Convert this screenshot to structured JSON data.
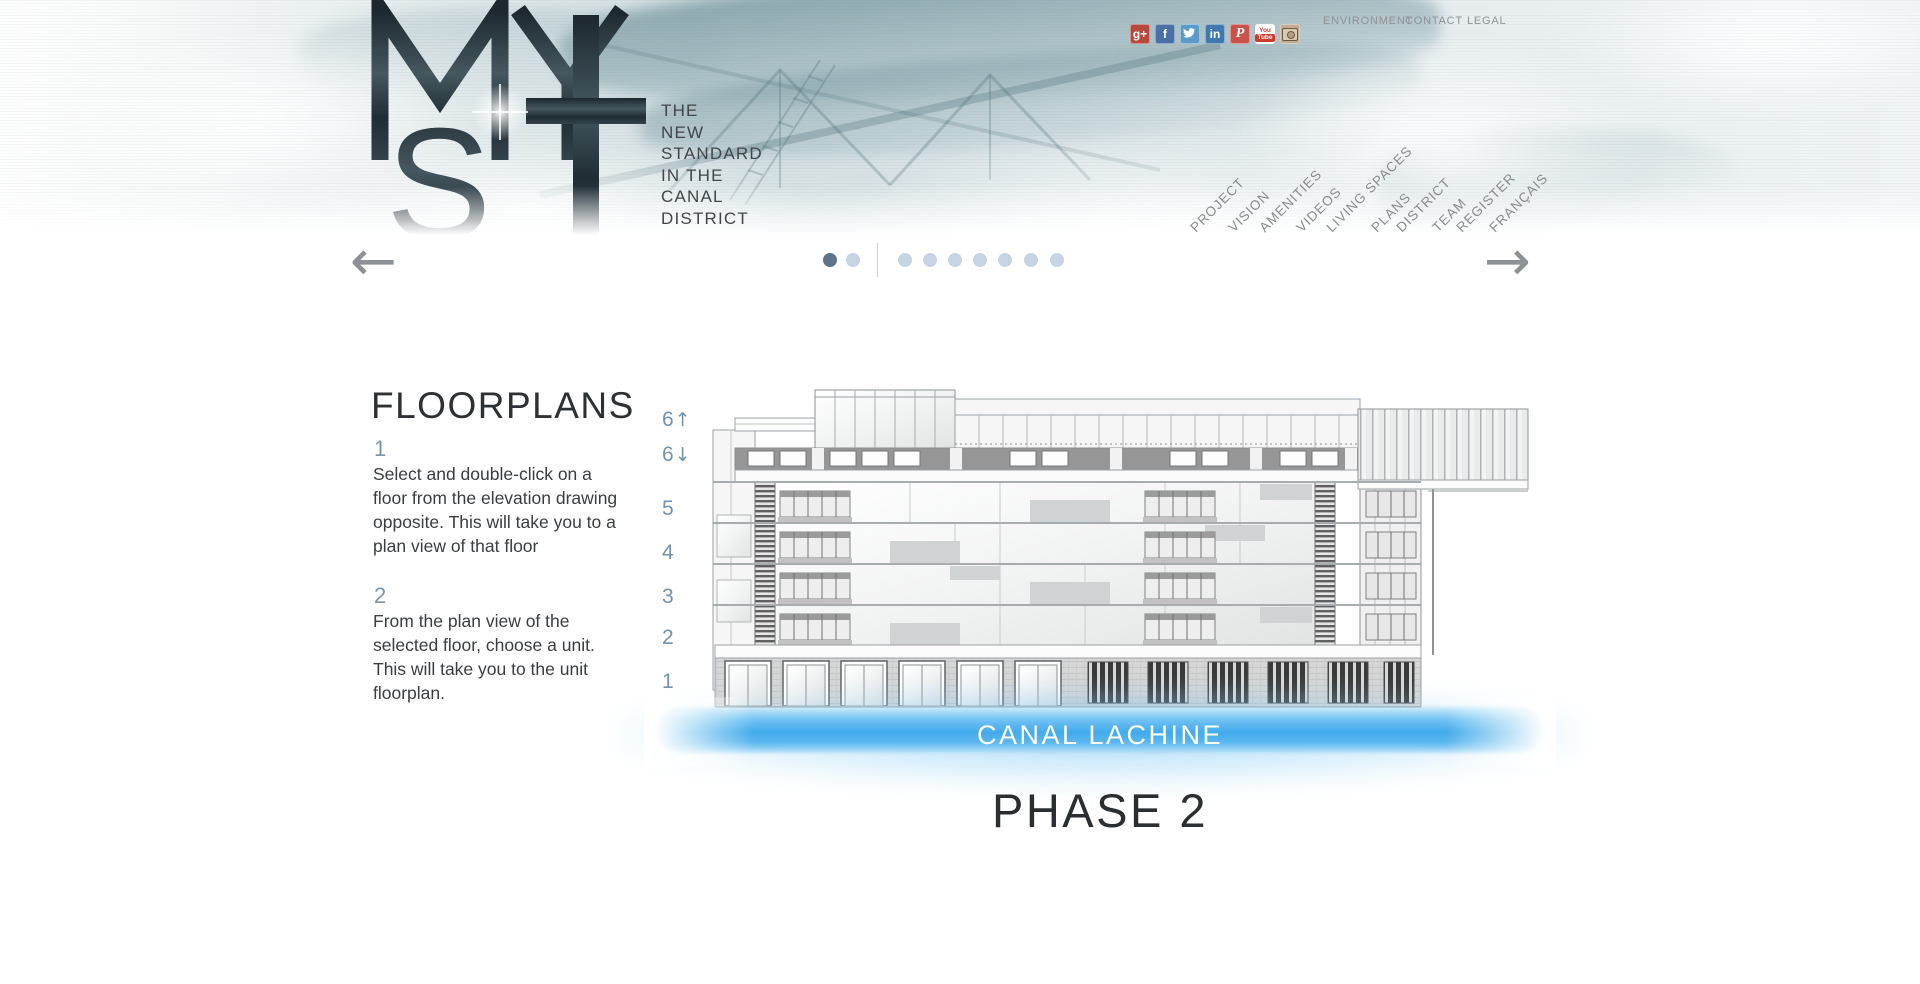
{
  "header": {
    "logo_letters": [
      "M",
      "Y",
      "S",
      "T"
    ],
    "tagline_lines": [
      "THE",
      "NEW",
      "STANDARD",
      "IN THE",
      "CANAL",
      "DISTRICT"
    ],
    "social": [
      {
        "name": "google-plus",
        "glyph": "g+",
        "color": "#b6493b"
      },
      {
        "name": "facebook",
        "glyph": "f",
        "color": "#4a70a8"
      },
      {
        "name": "twitter",
        "color": "#5b9bca"
      },
      {
        "name": "linkedin",
        "glyph": "in",
        "color": "#3e7ab0"
      },
      {
        "name": "pinterest",
        "glyph": "P",
        "color": "#c9524b"
      },
      {
        "name": "youtube",
        "glyph_top": "You",
        "glyph_bottom": "Tube",
        "color": "#ffffff",
        "accent": "#cc3a2c"
      },
      {
        "name": "instagram",
        "color": "#c3ac92"
      }
    ],
    "top_links": [
      {
        "label": "ENVIRONMENT"
      },
      {
        "label": "CONTACT"
      },
      {
        "label": "LEGAL"
      }
    ],
    "nav_items": [
      {
        "label": "PROJECT"
      },
      {
        "label": "VISION"
      },
      {
        "label": "AMENITIES"
      },
      {
        "label": "VIDEOS"
      },
      {
        "label": "LIVING SPACES"
      },
      {
        "label": "PLANS"
      },
      {
        "label": "DISTRICT"
      },
      {
        "label": "TEAM"
      },
      {
        "label": "REGISTER"
      },
      {
        "label": "FRANÇAIS"
      }
    ]
  },
  "carousel": {
    "prev_arrow": "←",
    "next_arrow": "→",
    "group1_dot_count": 2,
    "group1_active_index": 0,
    "group2_dot_count": 7,
    "dot_active_color": "#5f7389",
    "dot_inactive_color": "#c7d4e4"
  },
  "floorplans": {
    "title": "FLOORPLANS",
    "step1_number": "1",
    "step1_text": "Select and double-click on a floor from the elevation drawing opposite. This will take you to a plan view of that floor",
    "step2_number": "2",
    "step2_text": "From the plan view of the selected floor, choose a unit. This will take you to the unit floorplan.",
    "floor_labels": [
      {
        "label": "6",
        "arrow": "↑"
      },
      {
        "label": "6",
        "arrow": "↓"
      },
      {
        "label": "5",
        "arrow": ""
      },
      {
        "label": "4",
        "arrow": ""
      },
      {
        "label": "3",
        "arrow": ""
      },
      {
        "label": "2",
        "arrow": ""
      },
      {
        "label": "1",
        "arrow": ""
      }
    ],
    "canal_label": "CANAL LACHINE",
    "phase_label": "PHASE 2"
  },
  "colors": {
    "water_blue": "#41aaec",
    "floor_label_blue": "#7492ab",
    "nav_gray": "#8a8a8a",
    "arrow_gray": "#8d9196",
    "title_dark": "#2e3134"
  }
}
